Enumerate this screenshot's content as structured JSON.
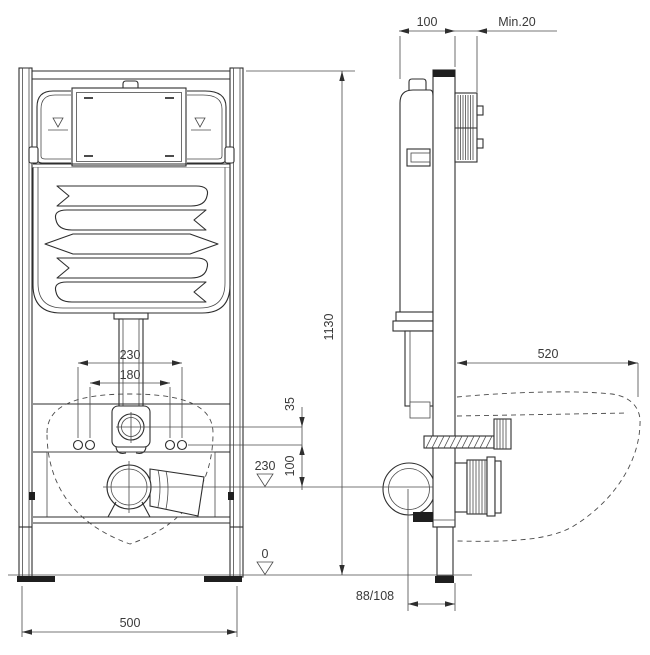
{
  "drawing": {
    "background": "#ffffff",
    "line_color": "#2e2e2e",
    "dimensions": {
      "dim_frame_depth": "100",
      "dim_wall_min": "Min.20",
      "dim_frame_height": "1130",
      "dim_bowl_depth": "520",
      "dim_flush_bend_width": "230",
      "dim_bolt_spacing": "180",
      "dim_inlet_offset": "35",
      "dim_bolt_to_drain": "100",
      "dim_drain_height": "230",
      "dim_floor_level": "0",
      "dim_frame_width": "500",
      "dim_drain_pipe": "88/108"
    }
  }
}
